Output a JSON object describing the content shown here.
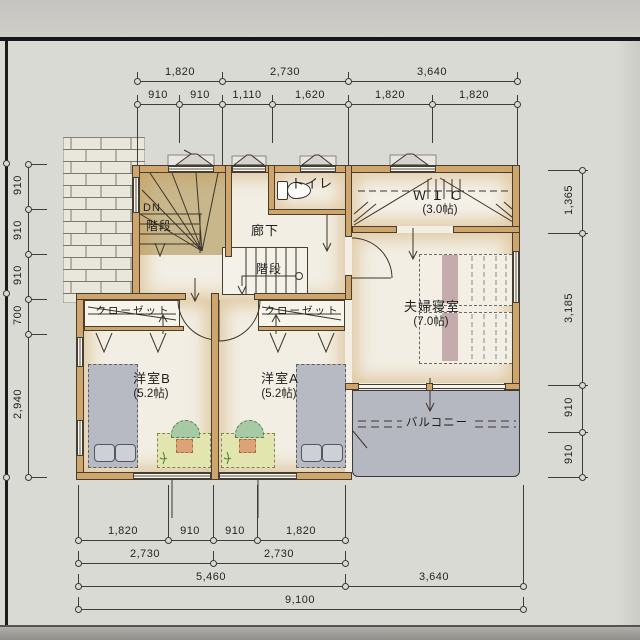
{
  "rooms": {
    "toilet": {
      "label": "トイレ"
    },
    "wic": {
      "label": "ＷＩＣ",
      "size": "(3.0帖)"
    },
    "corridor": {
      "label": "廊下"
    },
    "stairs_upper": {
      "dn": "DN",
      "label": "階段"
    },
    "stairs_center": {
      "label": "階段"
    },
    "master_bedroom": {
      "label": "夫婦寝室",
      "size": "(7.0帖)"
    },
    "balcony": {
      "label": "バルコニー"
    },
    "closet_b": {
      "label": "クローゼット"
    },
    "closet_a": {
      "label": "クローゼット"
    },
    "room_b": {
      "label": "洋室B",
      "size": "(5.2帖)"
    },
    "room_a": {
      "label": "洋室A",
      "size": "(5.2帖)"
    }
  },
  "dimensions": {
    "top_row1": [
      "1,820",
      "2,730",
      "3,640"
    ],
    "top_row2": [
      "910",
      "910",
      "1,110",
      "1,620",
      "1,820",
      "1,820"
    ],
    "bottom_row1": [
      "1,820",
      "910",
      "910",
      "1,820"
    ],
    "bottom_row2": [
      "2,730",
      "2,730"
    ],
    "bottom_row3": [
      "5,460",
      "3,640"
    ],
    "bottom_row4": [
      "9,100"
    ],
    "left": [
      "910",
      "910",
      "910",
      "700",
      "2,940"
    ],
    "right": [
      "1,365",
      "3,185",
      "910",
      "910"
    ]
  },
  "colors": {
    "wall": "#d0a56c",
    "floor": "#f2eee3",
    "stairs": "#c9b78c",
    "balcony": "#b5b8c0",
    "bed_grey": "#b7bac2",
    "bed_pillow": "#cdd0d6",
    "desk": "#e3e5ae",
    "chair": "#a6caa3",
    "bed_stripe": "#c6abac",
    "paper": "#dadad5",
    "line": "#3c3c3c"
  }
}
